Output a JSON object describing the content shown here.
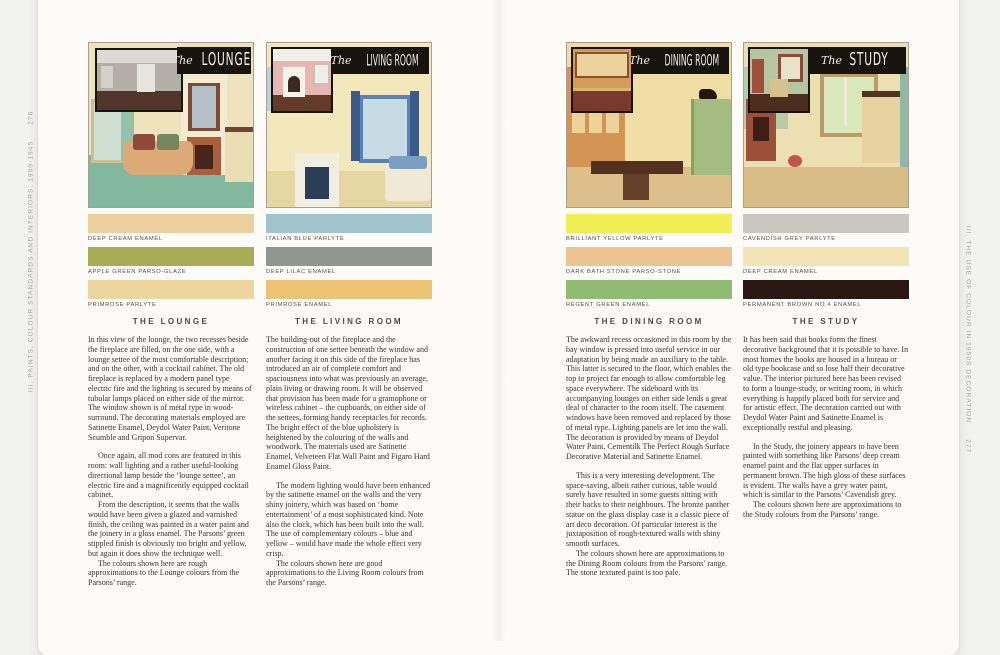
{
  "page": {
    "left_margin": {
      "label": "III. PAINTS, COLOUR STANDARDS AND INTERIORS, 1900-1945",
      "page_number": "276"
    },
    "right_margin": {
      "label": "III. THE USE OF COLOUR IN 1950S DECORATION",
      "page_number": "277"
    }
  },
  "rooms": [
    {
      "id": "lounge",
      "banner": {
        "script": "The",
        "caps": "LOUNGE"
      },
      "heading": "THE LOUNGE",
      "swatches": [
        {
          "name": "DEEP CREAM ENAMEL",
          "color": "#ebd09e",
          "textured": false
        },
        {
          "name": "APPLE GREEN PARSO-GLAZE",
          "color": "#a8ad55",
          "textured": true
        },
        {
          "name": "PRIMROSE PARLYTE",
          "color": "#eed5a0",
          "textured": false
        }
      ],
      "paragraphs": [
        "In this view of the lounge, the two recesses beside the fireplace are filled, on the one side, with a lounge settee of the most comfortable description; and on the other, with a cocktail cabinet. The old fireplace is replaced by a modern panel type electric fire and the lighting is secured by means of tubular lamps placed on either side of the mirror. The window shown is of metal type in wood-surround. The decorating materials employed are Satinette Enamel, Deydol Water Paint, Veritone Scumble and Gripon Supervar.",
        "Once again, all mod cons are featured in this room: wall lighting and a rather useful-looking directional lamp beside the ‘lounge settee’, an electric fire and a magnificently equipped cocktail cabinet.",
        "From the description, it seems that the walls would have been given a glazed and varnished finish, the ceiling was painted in a water paint and the joinery in a gloss enamel. The Parsons’ green stippled finish is obviously too bright and yellow, but again it does show the technique well.",
        "The colours shown here are rough approximations to the Lounge colours from the Parsons’ range."
      ]
    },
    {
      "id": "living-room",
      "banner": {
        "script": "The",
        "caps": "LIVING ROOM"
      },
      "heading": "THE LIVING ROOM",
      "swatches": [
        {
          "name": "ITALIAN BLUE PARLYTE",
          "color": "#a0c3cd",
          "textured": false
        },
        {
          "name": "DEEP LILAC ENAMEL",
          "color": "#8e988e",
          "textured": false
        },
        {
          "name": "PRIMROSE ENAMEL",
          "color": "#ecc374",
          "textured": false
        }
      ],
      "paragraphs": [
        "The building-out of the fireplace and the construction of one settee beneath the window and another facing it on this side of the fireplace has introduced an air of complete comfort and spaciousness into what was previously an average, plain living or drawing room. It will be observed that provision has been made for a gramophone or wireless cabinet – the cupboards, on either side of the settees, forming handy receptacles for records. The bright effect of the blue upholstery is heightened by the colouring of the walls and woodwork. The materials used are Satinette Enamel, Velveteen Flat Wall Paint and Figaro Hard Enamel Gloss Paint.",
        "The modern lighting would have been enhanced by the satinette enamel on the walls and the very shiny joinery, which was based on ‘home entertainment’ of a most sophisticated kind. Note also the clock, which has been built into the wall. The use of complementary colours – blue and yellow – would have made the whole effect very crisp.",
        "The colours shown here are good approximations to the Living Room colours from the Parsons’ range."
      ]
    },
    {
      "id": "dining-room",
      "banner": {
        "script": "The",
        "caps": "DINING ROOM"
      },
      "heading": "THE DINING ROOM",
      "swatches": [
        {
          "name": "BRILLIANT YELLOW PARLYTE",
          "color": "#f1ed55",
          "textured": false
        },
        {
          "name": "DARK BATH STONE PARSO-STONE",
          "color": "#ecc391",
          "textured": true
        },
        {
          "name": "REGENT GREEN ENAMEL",
          "color": "#90bb72",
          "textured": false
        }
      ],
      "paragraphs": [
        "The awkward recess occasioned in this room by the bay window is pressed into useful service in our adaptation by being made an auxiliary to the table. This latter is secured to the floor, which enables the top to project far enough to allow comfortable leg space everywhere. The sideboard with its accompanying lounges on either side lends a great deal of character to the room itself. The casement windows have been removed and replaced by those of metal type. Lighting panels are let into the wall. The decoration is provided by means of Deydol Water Paint, Cementilk The Perfect Rough Surface Decorative Material and Satinette Enamel.",
        "This is a very interesting development. The space-saving, albeit rather curious, table would surely have resulted in some guests sitting with their backs to their neighbours. The bronze panther statue on the glass display case is a classic piece of art deco decoration. Of particular interest is the juxtaposition of rough-textured walls with shiny smooth surfaces.",
        "The colours shown here are approximations to the Dining Room colours from the Parsons’ range. The stone textured paint is too pale."
      ]
    },
    {
      "id": "study",
      "banner": {
        "script": "The",
        "caps": "STUDY"
      },
      "heading": "THE STUDY",
      "swatches": [
        {
          "name": "CAVENDISH GREY PARLYTE",
          "color": "#c9c6bf",
          "textured": false
        },
        {
          "name": "DEEP CREAM ENAMEL",
          "color": "#f3e4b6",
          "textured": false
        },
        {
          "name": "PERMANENT BROWN NO.4 ENAMEL",
          "color": "#2b1713",
          "textured": false
        }
      ],
      "paragraphs": [
        "It has been said that books form the finest decorative background that it is possible to have. In most homes the books are housed in a bureau or old type bookcase and so lose half their decorative value. The interior pictured here has been revised to form a lounge-study, or writing room, in which everything is happily placed both for service and for artistic effect. The decoration carried out with Deydol Water Paint and Satinette Enamel is exceptionally restful and pleasing.",
        "In the Study, the joinery appears to have been painted with something like Parsons’ deep cream enamel paint and the flat upper surfaces in permanent brown. The high gloss of these surfaces is evident. The walls have a grey water paint, which is similar to the Parsons’ Cavendish grey.",
        "The colours shown here are approximations to the Study colours from the Parsons’ range."
      ]
    }
  ]
}
